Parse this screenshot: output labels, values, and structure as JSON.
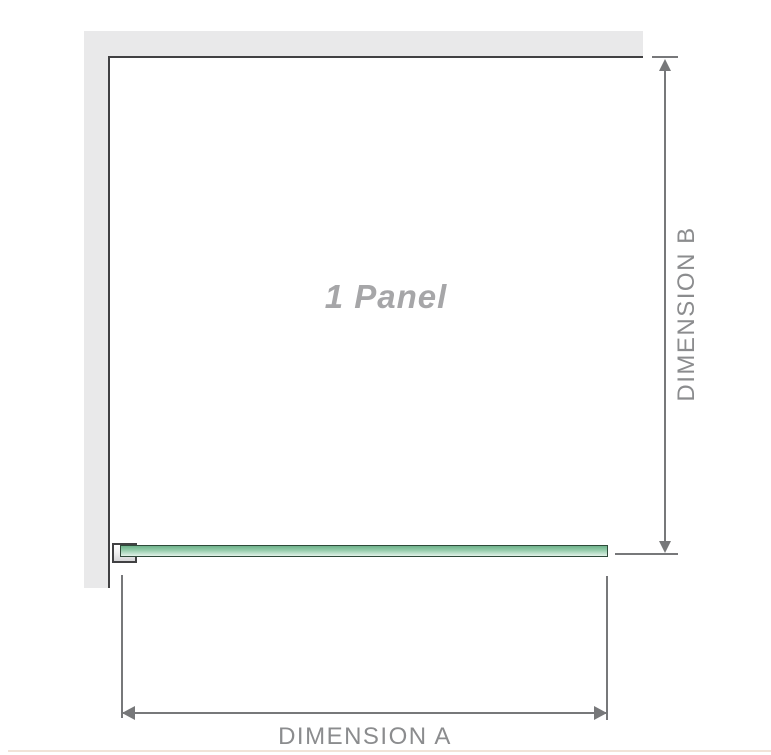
{
  "diagram": {
    "type": "shower-screen-installation-plan",
    "panel_label": "1 Panel",
    "dimension_a_label": "DIMENSION A",
    "dimension_b_label": "DIMENSION B"
  },
  "colors": {
    "wall_fill": "#e9e9ea",
    "wall_edge": "#414143",
    "glass_border": "#2f4a3a",
    "glass_top": "#6fb28c",
    "glass_bottom": "#e3f2e9",
    "dimension_line": "#77787a",
    "dimension_label_text": "#8b8c8e",
    "panel_label_text": "#a6a6a8",
    "baseline_accent": "#f1e3d8"
  }
}
